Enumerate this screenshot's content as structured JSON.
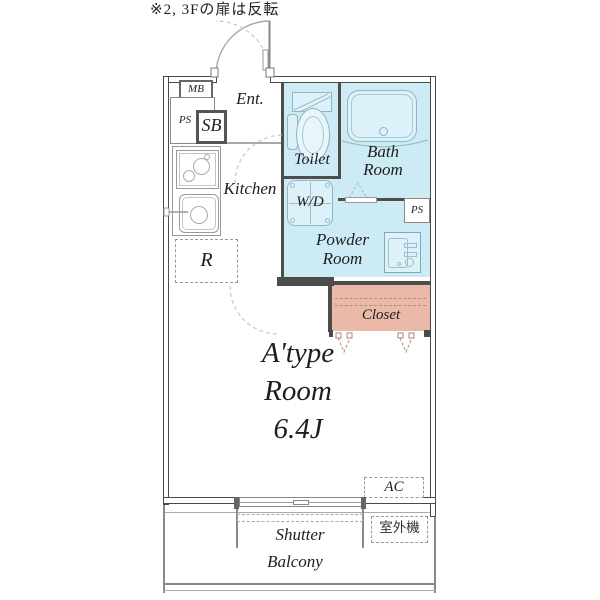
{
  "note": "※2, 3Fの扉は反転",
  "colors": {
    "wet_area_fill": "#cdebf4",
    "fixture_fill": "#ddf1f8",
    "closet_fill": "#eab9a7",
    "wall_color": "#4a4a4a",
    "fixture_line": "#8fb6c4",
    "text_color": "#1e1e1e"
  },
  "labels": {
    "mb": "MB",
    "ps_left": "PS",
    "sb": "SB",
    "ent": "Ent.",
    "kitchen": "Kitchen",
    "toilet": "Toilet",
    "bath_line1": "Bath",
    "bath_line2": "Room",
    "wd": "W/D",
    "powder_line1": "Powder",
    "powder_line2": "Room",
    "ps_right": "PS",
    "fridge": "R",
    "closet": "Closet",
    "room_line1": "A'type",
    "room_line2": "Room",
    "room_line3": "6.4J",
    "ac": "AC",
    "shutter": "Shutter",
    "balcony": "Balcony",
    "outdoor_unit": "室外機"
  }
}
